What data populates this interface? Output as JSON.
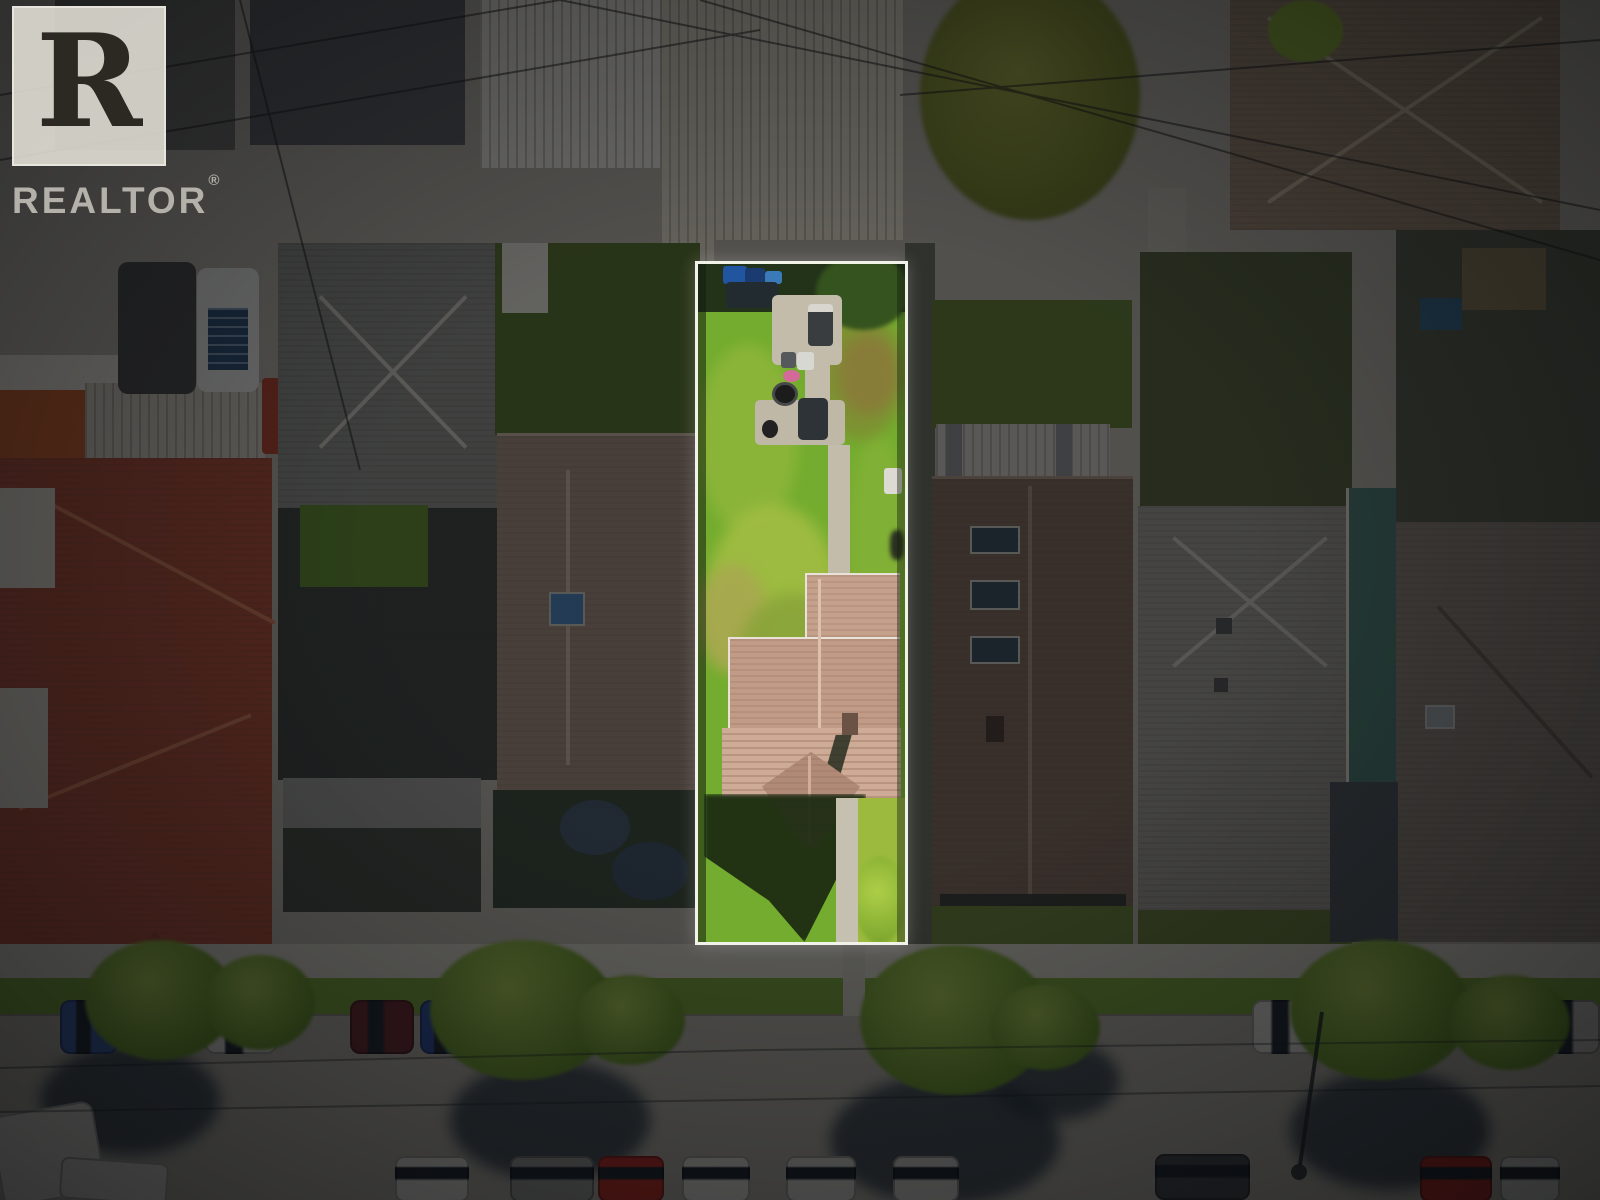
{
  "branding": {
    "logo_word": "REALTOR",
    "registered_mark": "®"
  },
  "image": {
    "type": "aerial-drone-photo",
    "subject": "residential property lot highlighted with white outline; surrounding neighborhood darkened",
    "highlighted_lot": {
      "border_color": "#f8f6f0",
      "lawn_color": "#73ac2e",
      "house_roof_color": "#c29b86",
      "concrete_path_color": "#c3bcab",
      "features": [
        "back-lane bins",
        "concrete pad",
        "patio with grill and fire pit",
        "S-shaped garden path",
        "gabled house roof with chimney",
        "front walkway"
      ]
    },
    "overlay_color": "rgba(3,4,6,0.68)",
    "neighborhood": {
      "left_roof_color": "#ac4e39",
      "right_roof_color": "#7c675a",
      "gray_roof_color": "#97958e",
      "alley_vehicles": 4,
      "skylights_on_right_house": 3
    },
    "street": {
      "north_curb_parked_cars": 8,
      "south_curb_parked_cars": 11,
      "boulevard_trees": 8,
      "sidewalk_color": "#cdcabf"
    }
  }
}
